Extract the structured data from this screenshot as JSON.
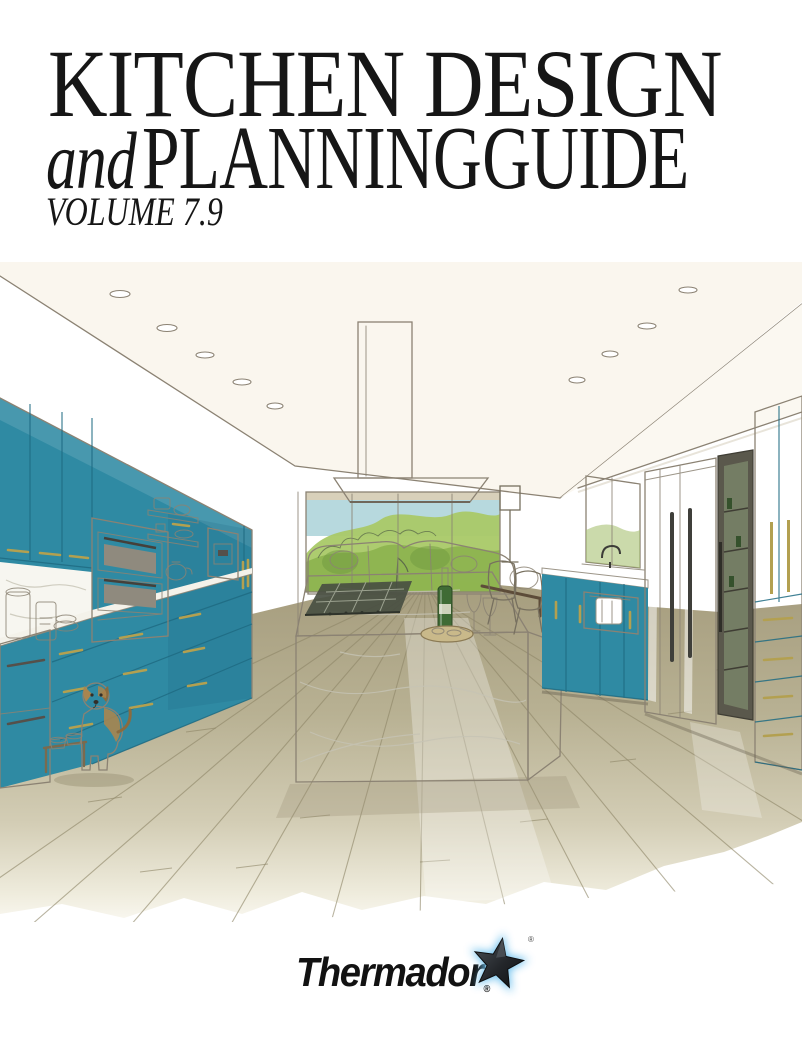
{
  "cover": {
    "title_line1": "KITCHEN DESIGN",
    "title_line2_prefix": "and",
    "title_line2": "PLANNING GUIDE",
    "volume": "VOLUME 7.9"
  },
  "brand": {
    "wordmark": "Thermador",
    "registered_mark": "®"
  },
  "illustration": {
    "description": "Watercolor sketch of a modern kitchen: teal flat-panel cabinetry with brass pulls on both walls, stacked wall ovens, floating shelves with white dishes, a coffee machine niche, a white marble waterfall island with gas cooktop, wine bottle, two glasses and a serving board, stainless steel refrigerator columns, a glass-front wine column, a farmhouse sink below a window, a window wall with green trees, a wood plank floor, and a brown-and-white dog beside raised feeding bowls under a ceiling with recessed lights."
  },
  "theme": {
    "text": "#161616",
    "teal": "#2f8aa3",
    "teal_dark": "#1f6b82",
    "brass": "#b3a050",
    "cream": "#e9e2cd",
    "floor": "#b3ab8d",
    "sketch_line": "#8b8273",
    "green_light": "#a9c967",
    "green_dark": "#8cb24e",
    "sky": "#b7d9de",
    "steel": "#d3cec2",
    "star": "#1c1f22",
    "star_glow": "#6cc0ee"
  }
}
